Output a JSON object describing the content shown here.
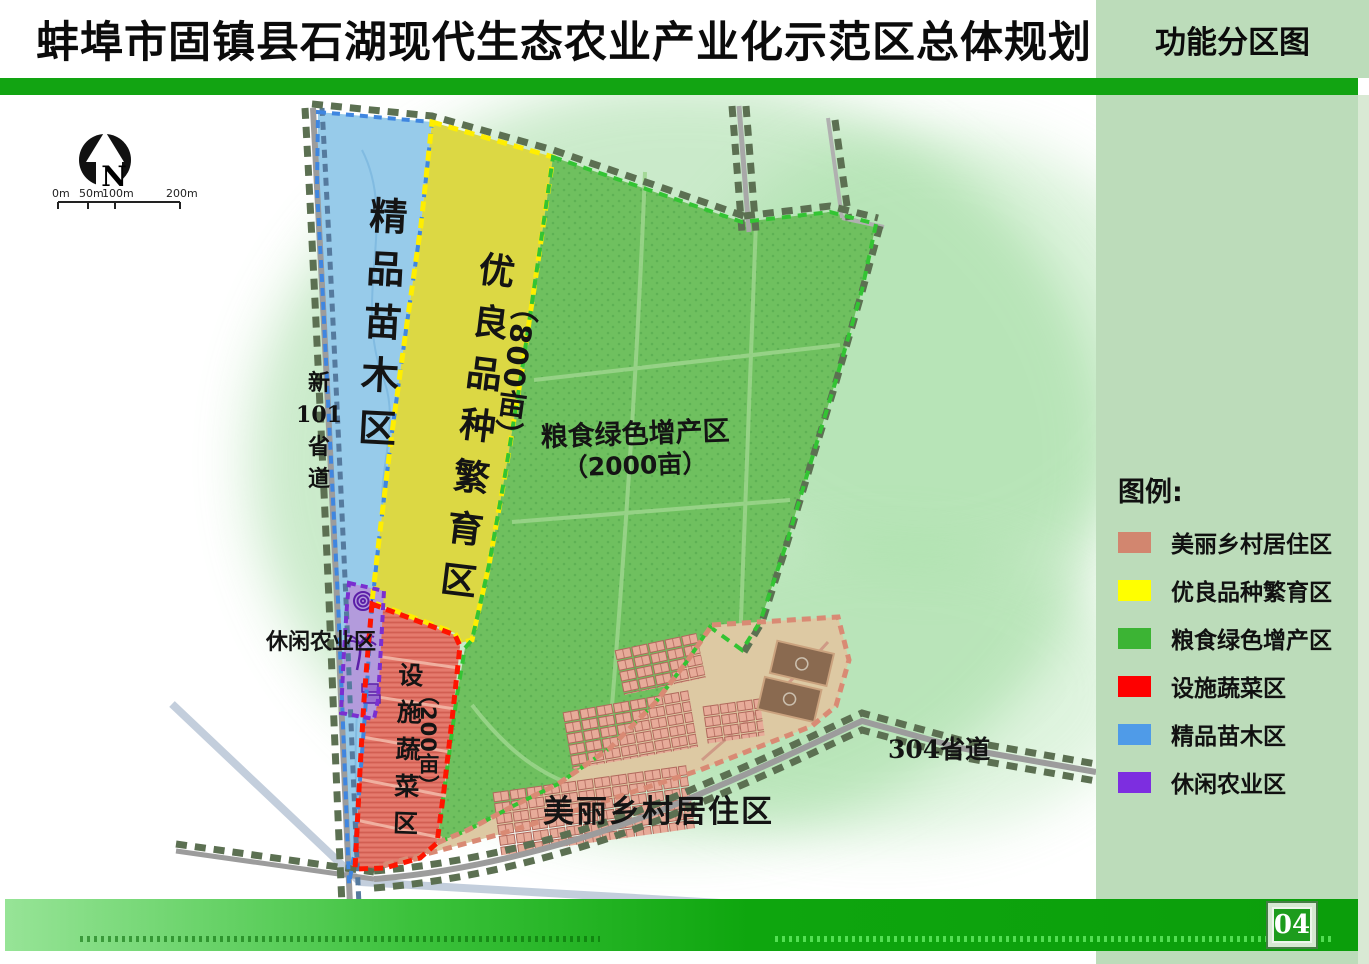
{
  "header": {
    "title": "蚌埠市固镇县石湖现代生态农业产业化示范区总体规划",
    "tab": "功能分区图"
  },
  "footer": {
    "page_number": "04"
  },
  "compass": {
    "n": "N"
  },
  "scalebar": {
    "labels": [
      "0m",
      "50m",
      "100m",
      "200m"
    ]
  },
  "legend": {
    "title": "图例:",
    "items": [
      {
        "label": "美丽乡村居住区",
        "color": "#d2866f"
      },
      {
        "label": "优良品种繁育区",
        "color": "#ffff00"
      },
      {
        "label": "粮食绿色增产区",
        "color": "#3cb434"
      },
      {
        "label": "设施蔬菜区",
        "color": "#fe0000"
      },
      {
        "label": "精品苗木区",
        "color": "#4f9be8"
      },
      {
        "label": "休闲农业区",
        "color": "#7d2ee0"
      }
    ]
  },
  "map": {
    "zones": {
      "seedling": {
        "label": "精品苗木区",
        "color": "#97cbea"
      },
      "breeding": {
        "label": "优良品种繁育区",
        "area": "（800亩）",
        "color": "#dcd844"
      },
      "grain": {
        "label": "粮食绿色增产区",
        "area": "（2000亩）",
        "color": "#6fc05f"
      },
      "vegetable": {
        "label": "设施蔬菜区",
        "area": "（200亩）",
        "color": "#e57a6d"
      },
      "leisure": {
        "label": "休闲农业区",
        "color": "#b39bdc"
      },
      "village": {
        "label": "美丽乡村居住区",
        "color": "#ddc9a3"
      }
    },
    "roads": {
      "r101": {
        "prefix": "新",
        "number": "101",
        "suffix": "省道"
      },
      "r304": {
        "label": "304省道"
      }
    }
  },
  "theme": {
    "top_bar": "#12a412",
    "sidebar": "#bcdcba",
    "footer_bar_left": "#97e497",
    "footer_bar_right": "#0b9e0b"
  }
}
